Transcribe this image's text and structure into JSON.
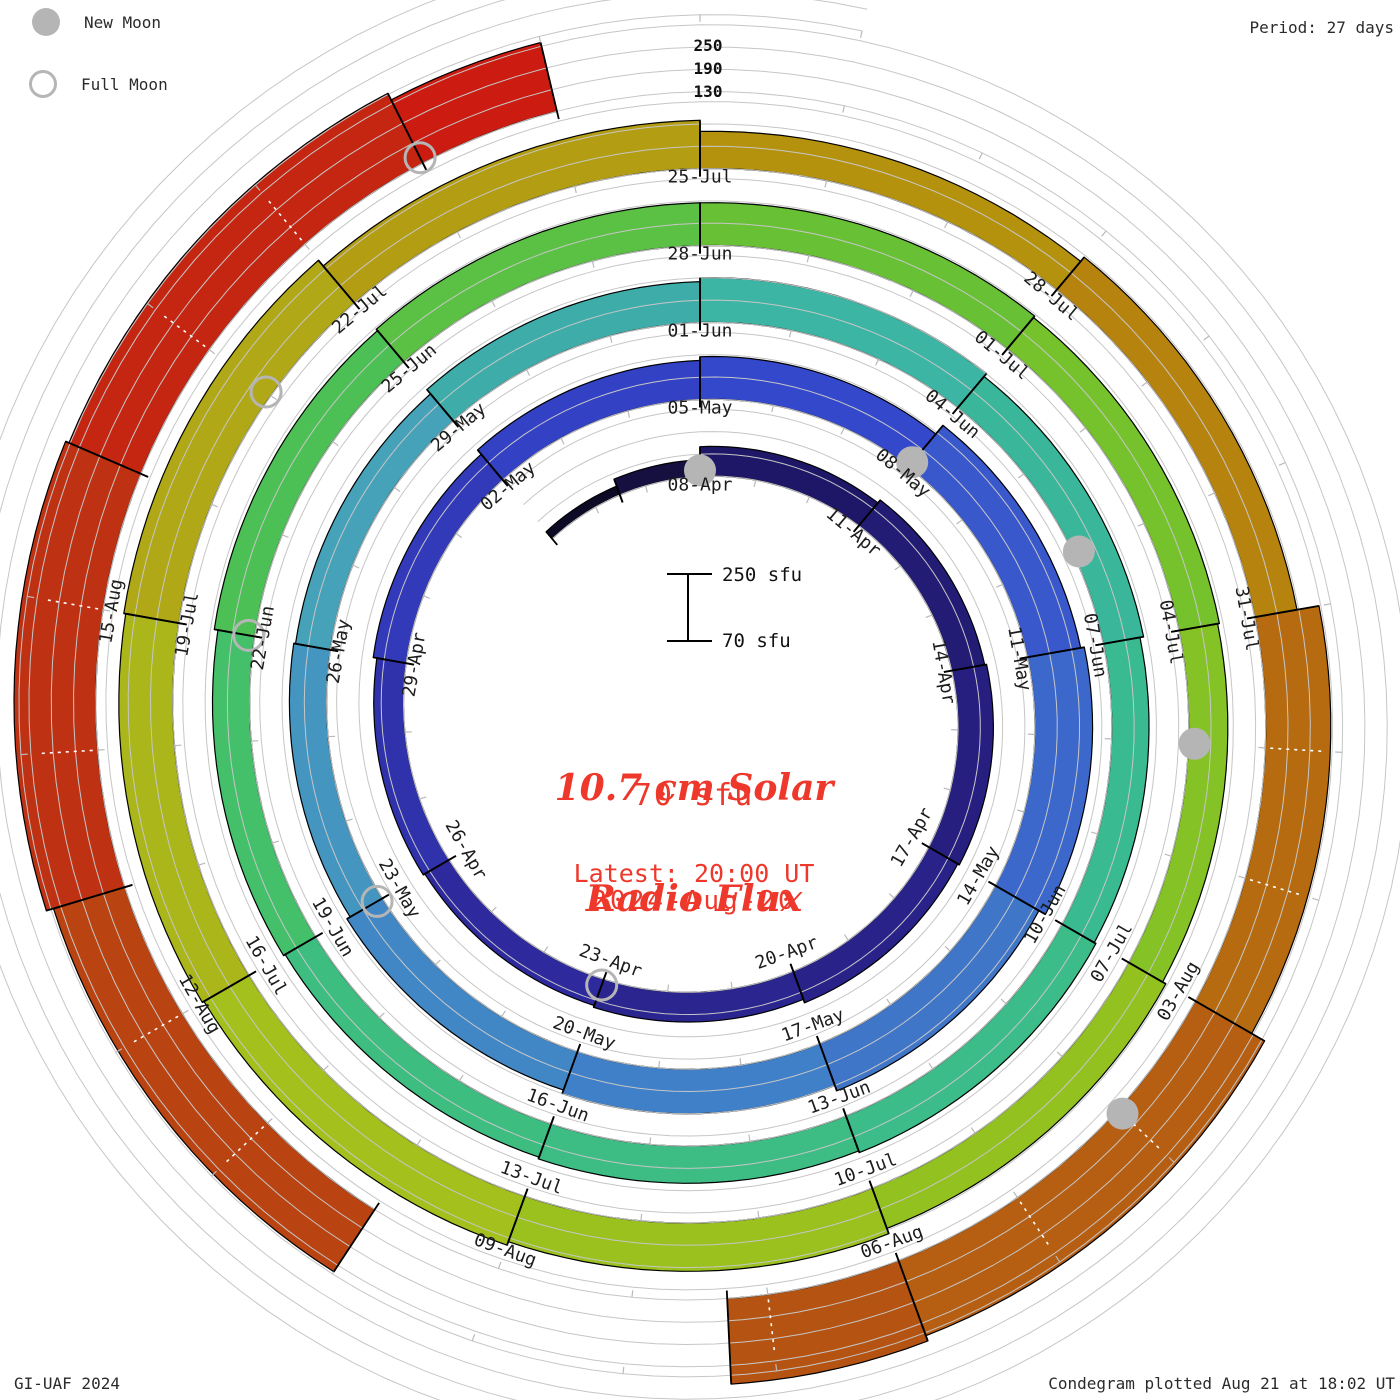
{
  "legend": {
    "new_moon": "New Moon",
    "full_moon": "Full Moon"
  },
  "header": {
    "period": "Period: 27 days"
  },
  "radial_axis": {
    "labels": [
      "250",
      "190",
      "130"
    ]
  },
  "scalebar": {
    "top": "250 sfu",
    "bottom": "70 sfu"
  },
  "center": {
    "title_line1": "10.7 cm Solar",
    "title_line2": "Radio Flux",
    "current_value": "70 sfu",
    "latest_line1": "Latest: 20:00 UT",
    "latest_line2": "2024-Aug-20"
  },
  "footer": {
    "left": "GI-UAF 2024",
    "right": "Condegram plotted Aug 21 at 18:02 UT"
  },
  "colors": {
    "accent_red": "#ee382b",
    "moon_gray": "#b5b5b5",
    "grid_gray": "#c6c6c6",
    "day_tick_gray": "#b9b9b9",
    "label_color": "#1c1c1c",
    "bar_outline": "#000000"
  },
  "chart_data": {
    "type": "spiral-bar-condegram",
    "title": "10.7 cm Solar Radio Flux",
    "period_days": 27,
    "flux_baseline_sfu": 70,
    "flux_gridlines_sfu": [
      70,
      130,
      190,
      250
    ],
    "start_date": "2024-Apr-05",
    "end_date": "2024-Aug-20",
    "direction": "clockwise-from-top",
    "segments": [
      {
        "date": "05-Apr",
        "d0": 0,
        "d1": 1.5,
        "flux": 95,
        "color": "#0d0a26"
      },
      {
        "date": "06-Apr",
        "d0": 1.5,
        "d1": 3,
        "flux": 115,
        "color": "#161040"
      },
      {
        "date": "08-Apr",
        "d0": 3,
        "d1": 6,
        "flux": 150,
        "color": "#1e1768"
      },
      {
        "date": "11-Apr",
        "d0": 6,
        "d1": 9,
        "flux": 160,
        "color": "#221c74"
      },
      {
        "date": "14-Apr",
        "d0": 9,
        "d1": 12,
        "flux": 165,
        "color": "#261f80"
      },
      {
        "date": "17-Apr",
        "d0": 12,
        "d1": 15,
        "flux": 160,
        "color": "#292288"
      },
      {
        "date": "20-Apr",
        "d0": 15,
        "d1": 18,
        "flux": 150,
        "color": "#2b2590"
      },
      {
        "date": "23-Apr",
        "d0": 18,
        "d1": 21,
        "flux": 145,
        "color": "#2e2a9e"
      },
      {
        "date": "26-Apr",
        "d0": 21,
        "d1": 24,
        "flux": 150,
        "color": "#3032ac"
      },
      {
        "date": "29-Apr",
        "d0": 24,
        "d1": 27,
        "flux": 160,
        "color": "#323aba"
      },
      {
        "date": "02-May",
        "d0": 27,
        "d1": 30,
        "flux": 175,
        "color": "#3341c4"
      },
      {
        "date": "05-May",
        "d0": 30,
        "d1": 33,
        "flux": 185,
        "color": "#3448cc"
      },
      {
        "date": "08-May",
        "d0": 33,
        "d1": 36,
        "flux": 215,
        "color": "#3858cc"
      },
      {
        "date": "11-May",
        "d0": 36,
        "d1": 39,
        "flux": 225,
        "color": "#3c68cc"
      },
      {
        "date": "14-May",
        "d0": 39,
        "d1": 42,
        "flux": 205,
        "color": "#3f76c8"
      },
      {
        "date": "17-May",
        "d0": 42,
        "d1": 45,
        "flux": 190,
        "color": "#4080c8"
      },
      {
        "date": "20-May",
        "d0": 45,
        "d1": 48,
        "flux": 180,
        "color": "#4187c6"
      },
      {
        "date": "23-May",
        "d0": 48,
        "d1": 51,
        "flux": 170,
        "color": "#4495c0"
      },
      {
        "date": "26-May",
        "d0": 51,
        "d1": 54,
        "flux": 165,
        "color": "#46a2b8"
      },
      {
        "date": "29-May",
        "d0": 54,
        "d1": 57,
        "flux": 180,
        "color": "#3eadaa"
      },
      {
        "date": "01-Jun",
        "d0": 57,
        "d1": 60,
        "flux": 190,
        "color": "#3cb5a4"
      },
      {
        "date": "04-Jun",
        "d0": 60,
        "d1": 63,
        "flux": 180,
        "color": "#3ab79a"
      },
      {
        "date": "07-Jun",
        "d0": 63,
        "d1": 66,
        "flux": 170,
        "color": "#3aba90"
      },
      {
        "date": "10-Jun",
        "d0": 66,
        "d1": 69,
        "flux": 175,
        "color": "#3cbc88"
      },
      {
        "date": "13-Jun",
        "d0": 69,
        "d1": 72,
        "flux": 170,
        "color": "#3dbd84"
      },
      {
        "date": "16-Jun",
        "d0": 72,
        "d1": 75,
        "flux": 165,
        "color": "#3ebd80"
      },
      {
        "date": "19-Jun",
        "d0": 75,
        "d1": 78,
        "flux": 170,
        "color": "#44bf6a"
      },
      {
        "date": "22-Jun",
        "d0": 78,
        "d1": 81,
        "flux": 180,
        "color": "#4cc054"
      },
      {
        "date": "25-Jun",
        "d0": 81,
        "d1": 84,
        "flux": 185,
        "color": "#5ac144"
      },
      {
        "date": "28-Jun",
        "d0": 84,
        "d1": 87,
        "flux": 185,
        "color": "#68c035"
      },
      {
        "date": "01-Jul",
        "d0": 87,
        "d1": 90,
        "flux": 180,
        "color": "#76c22c"
      },
      {
        "date": "04-Jul",
        "d0": 90,
        "d1": 93,
        "flux": 175,
        "color": "#84c226"
      },
      {
        "date": "07-Jul",
        "d0": 93,
        "d1": 96,
        "flux": 185,
        "color": "#92c120"
      },
      {
        "date": "10-Jul",
        "d0": 96,
        "d1": 99,
        "flux": 200,
        "color": "#9bc11e"
      },
      {
        "date": "13-Jul",
        "d0": 99,
        "d1": 102,
        "flux": 210,
        "color": "#a3c01c"
      },
      {
        "date": "16-Jul",
        "d0": 102,
        "d1": 105,
        "flux": 215,
        "color": "#aab61a"
      },
      {
        "date": "19-Jul",
        "d0": 105,
        "d1": 108,
        "flux": 220,
        "color": "#b0a817"
      },
      {
        "date": "22-Jul",
        "d0": 108,
        "d1": 111,
        "flux": 200,
        "color": "#b39d12"
      },
      {
        "date": "25-Jul",
        "d0": 111,
        "d1": 114,
        "flux": 170,
        "color": "#b5920e"
      },
      {
        "date": "28-Jul",
        "d0": 114,
        "d1": 117,
        "flux": 185,
        "color": "#b6830f"
      },
      {
        "date": "31-Jul",
        "d0": 117,
        "d1": 120,
        "flux": 245,
        "color": "#b66b10"
      },
      {
        "date": "03-Aug",
        "d0": 120,
        "d1": 123,
        "flux": 285,
        "color": "#b65e11"
      },
      {
        "date": "06-Aug",
        "d0": 123,
        "d1": 124.3,
        "flux": 300,
        "color": "#b55412"
      },
      {
        "date": "10-Aug",
        "d0": 127,
        "d1": 130,
        "flux": 270,
        "color": "#ba4312"
      },
      {
        "date": "13-Aug",
        "d0": 130,
        "d1": 133,
        "flux": 290,
        "color": "#bf3113"
      },
      {
        "date": "16-Aug",
        "d0": 133,
        "d1": 136,
        "flux": 280,
        "color": "#c52612"
      },
      {
        "date": "19-Aug",
        "d0": 136,
        "d1": 137,
        "flux": 260,
        "color": "#cc1b10"
      }
    ],
    "data_gap_days": [
      124.3,
      127
    ],
    "grid_track_extent_days": [
      0,
      166
    ],
    "dashed_tick_days": [
      117,
      137
    ],
    "new_moons": [
      {
        "date": "08-Apr",
        "day": 3
      },
      {
        "date": "08-May",
        "day": 33
      },
      {
        "date": "06-Jun",
        "day": 62
      },
      {
        "date": "05-Jul",
        "day": 91
      },
      {
        "date": "04-Aug",
        "day": 121
      }
    ],
    "full_moons": [
      {
        "date": "23-Apr",
        "day": 18
      },
      {
        "date": "23-May",
        "day": 48
      },
      {
        "date": "22-Jun",
        "day": 78
      },
      {
        "date": "21-Jul",
        "day": 107
      },
      {
        "date": "19-Aug",
        "day": 136
      }
    ],
    "date_labels": [
      {
        "text": "08-Apr",
        "day": 3
      },
      {
        "text": "11-Apr",
        "day": 6
      },
      {
        "text": "14-Apr",
        "day": 9
      },
      {
        "text": "17-Apr",
        "day": 12
      },
      {
        "text": "20-Apr",
        "day": 15
      },
      {
        "text": "23-Apr",
        "day": 18
      },
      {
        "text": "26-Apr",
        "day": 21
      },
      {
        "text": "29-Apr",
        "day": 24
      },
      {
        "text": "02-May",
        "day": 27
      },
      {
        "text": "05-May",
        "day": 30
      },
      {
        "text": "08-May",
        "day": 33
      },
      {
        "text": "11-May",
        "day": 36
      },
      {
        "text": "14-May",
        "day": 39
      },
      {
        "text": "17-May",
        "day": 42
      },
      {
        "text": "20-May",
        "day": 45
      },
      {
        "text": "23-May",
        "day": 48
      },
      {
        "text": "26-May",
        "day": 51
      },
      {
        "text": "29-May",
        "day": 54
      },
      {
        "text": "01-Jun",
        "day": 57
      },
      {
        "text": "04-Jun",
        "day": 60
      },
      {
        "text": "07-Jun",
        "day": 63
      },
      {
        "text": "10-Jun",
        "day": 66
      },
      {
        "text": "13-Jun",
        "day": 69
      },
      {
        "text": "16-Jun",
        "day": 72
      },
      {
        "text": "19-Jun",
        "day": 75
      },
      {
        "text": "22-Jun",
        "day": 78
      },
      {
        "text": "25-Jun",
        "day": 81
      },
      {
        "text": "28-Jun",
        "day": 84
      },
      {
        "text": "01-Jul",
        "day": 87
      },
      {
        "text": "04-Jul",
        "day": 90
      },
      {
        "text": "07-Jul",
        "day": 93
      },
      {
        "text": "10-Jul",
        "day": 96
      },
      {
        "text": "13-Jul",
        "day": 99
      },
      {
        "text": "16-Jul",
        "day": 102
      },
      {
        "text": "19-Jul",
        "day": 105
      },
      {
        "text": "22-Jul",
        "day": 108
      },
      {
        "text": "25-Jul",
        "day": 111
      },
      {
        "text": "28-Jul",
        "day": 114
      },
      {
        "text": "31-Jul",
        "day": 117
      },
      {
        "text": "03-Aug",
        "day": 120
      },
      {
        "text": "06-Aug",
        "day": 123
      },
      {
        "text": "09-Aug",
        "day": 126
      },
      {
        "text": "12-Aug",
        "day": 129
      },
      {
        "text": "15-Aug",
        "day": 132
      }
    ]
  }
}
